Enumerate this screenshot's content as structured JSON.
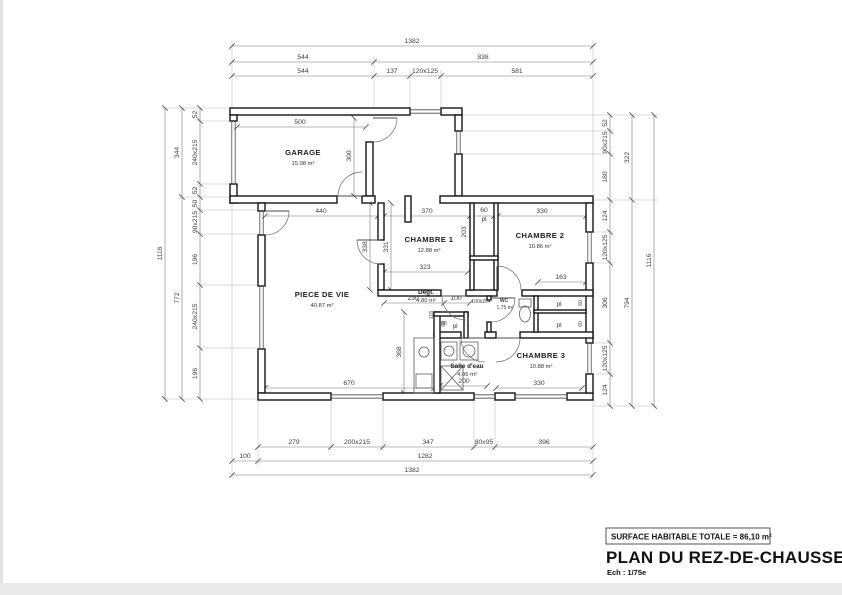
{
  "title_block": {
    "surface_total": "SURFACE HABITABLE TOTALE = 86,10 m²",
    "title": "PLAN DU REZ-DE-CHAUSSEE",
    "scale": "Ech : 1/75e"
  },
  "rooms": {
    "garage": {
      "name": "GARAGE",
      "area": "15.08 m²"
    },
    "piece_de_vie": {
      "name": "PIECE DE VIE",
      "area": "40.87 m²"
    },
    "chambre1": {
      "name": "CHAMBRE 1",
      "area": "12.88 m²"
    },
    "chambre2": {
      "name": "CHAMBRE 2",
      "area": "10.86 m²"
    },
    "chambre3": {
      "name": "CHAMBRE 3",
      "area": "10.88 m²"
    },
    "degagement": {
      "name": "Dégt.",
      "area": "4.80 m²"
    },
    "salle_eau": {
      "name": "Salle d'eau",
      "area": "4.06 m²"
    },
    "wc": {
      "name": "WC",
      "area": "1.75 m²"
    }
  },
  "closet_label": "pl",
  "dims": {
    "top1": [
      "1382"
    ],
    "top2": [
      "544",
      "838"
    ],
    "top3": [
      "544",
      "137",
      "120x125",
      "581"
    ],
    "bottom1": [
      "279",
      "200x215",
      "347",
      "80x95",
      "396"
    ],
    "bottom2": [
      "100",
      "1282"
    ],
    "bottom3": [
      "1382"
    ],
    "left_inner": [
      "52",
      "240x215",
      "52",
      "50",
      "90x215",
      "196",
      "240x215",
      "196"
    ],
    "left_mid": [
      "344",
      "772"
    ],
    "left_outer": [
      "1116"
    ],
    "right_inner": [
      "52",
      "90x215",
      "180",
      "124",
      "120x125",
      "306",
      "120x125",
      "124"
    ],
    "right_mid": [
      "322",
      "794"
    ],
    "right_outer": [
      "1116"
    ],
    "interior": {
      "garage_width": "500",
      "garage_depth": "300",
      "pdv_top": "440",
      "ch1_top": "370",
      "pl_top": "60",
      "ch2_top": "330",
      "pdv_h": "338",
      "ch1_h": "331",
      "closet_depth": "203",
      "ch1_bottom": "323",
      "pl_right": "163",
      "deg_a": "230",
      "deg_b": "100",
      "deg_c": "118",
      "deg_d": "80",
      "door": "100x204",
      "closet_sde": "60",
      "closet_r1": "60",
      "closet_r2": "60",
      "sde_wall": "368",
      "pdv_bottom": "670",
      "sde_bottom": "200",
      "ch3_bottom": "330"
    }
  }
}
